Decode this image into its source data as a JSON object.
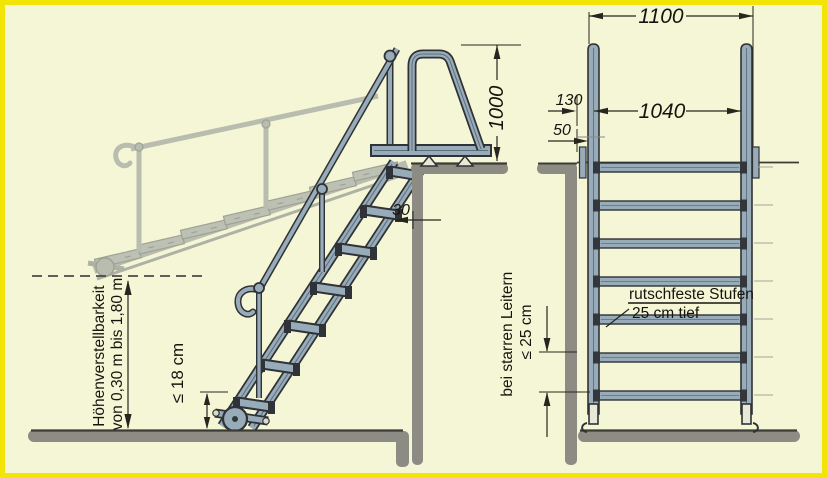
{
  "colors": {
    "background": "#f5f6d6",
    "border": "#f2e405",
    "metal": "#98abb8",
    "outline": "#2f3236",
    "shadow": "#b9bdb0",
    "wall": "#8c8c84",
    "text": "#15150f"
  },
  "side_view": {
    "height_adjust_line1": "Höhenverstellbarkeit",
    "height_adjust_line2": "von 0,30 m bis 1,80 m",
    "first_step_height_label": "≤ 18 cm",
    "gap_dim": "30",
    "hoop_height_dim": "1000"
  },
  "front_view": {
    "outer_width_dim": "1100",
    "inner_width_dim": "1040",
    "wall_offset_dim": "130",
    "wall_gap_dim": "50",
    "steps_label_line1": "rutschfeste Stufen",
    "steps_label_line2": "25 cm tief",
    "rigid_ladder_label_line1": "bei starren Leitern",
    "rigid_ladder_label_line2": "≤ 25 cm"
  }
}
